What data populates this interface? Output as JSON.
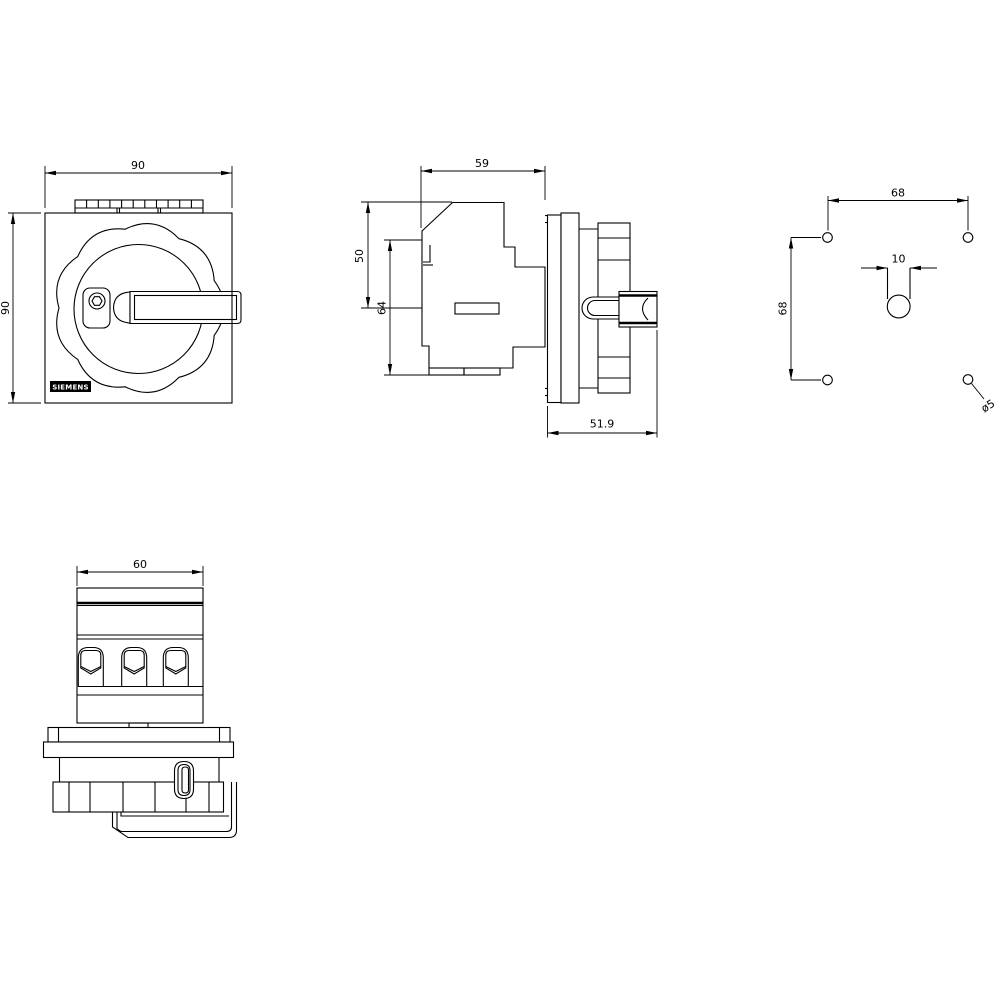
{
  "colors": {
    "line": "#000000",
    "background": "#ffffff"
  },
  "views": {
    "front": {
      "dim_width": "90",
      "dim_height": "90",
      "logo": "SIEMENS"
    },
    "side": {
      "dim_width": "59",
      "dim_upper": "50",
      "dim_total": "64",
      "dim_depth": "51.9"
    },
    "drilling": {
      "dim_horizontal": "68",
      "dim_vertical": "68",
      "dim_slot_width": "10",
      "dim_hole_diameter": "ø5"
    },
    "bottom": {
      "dim_width": "60"
    }
  }
}
